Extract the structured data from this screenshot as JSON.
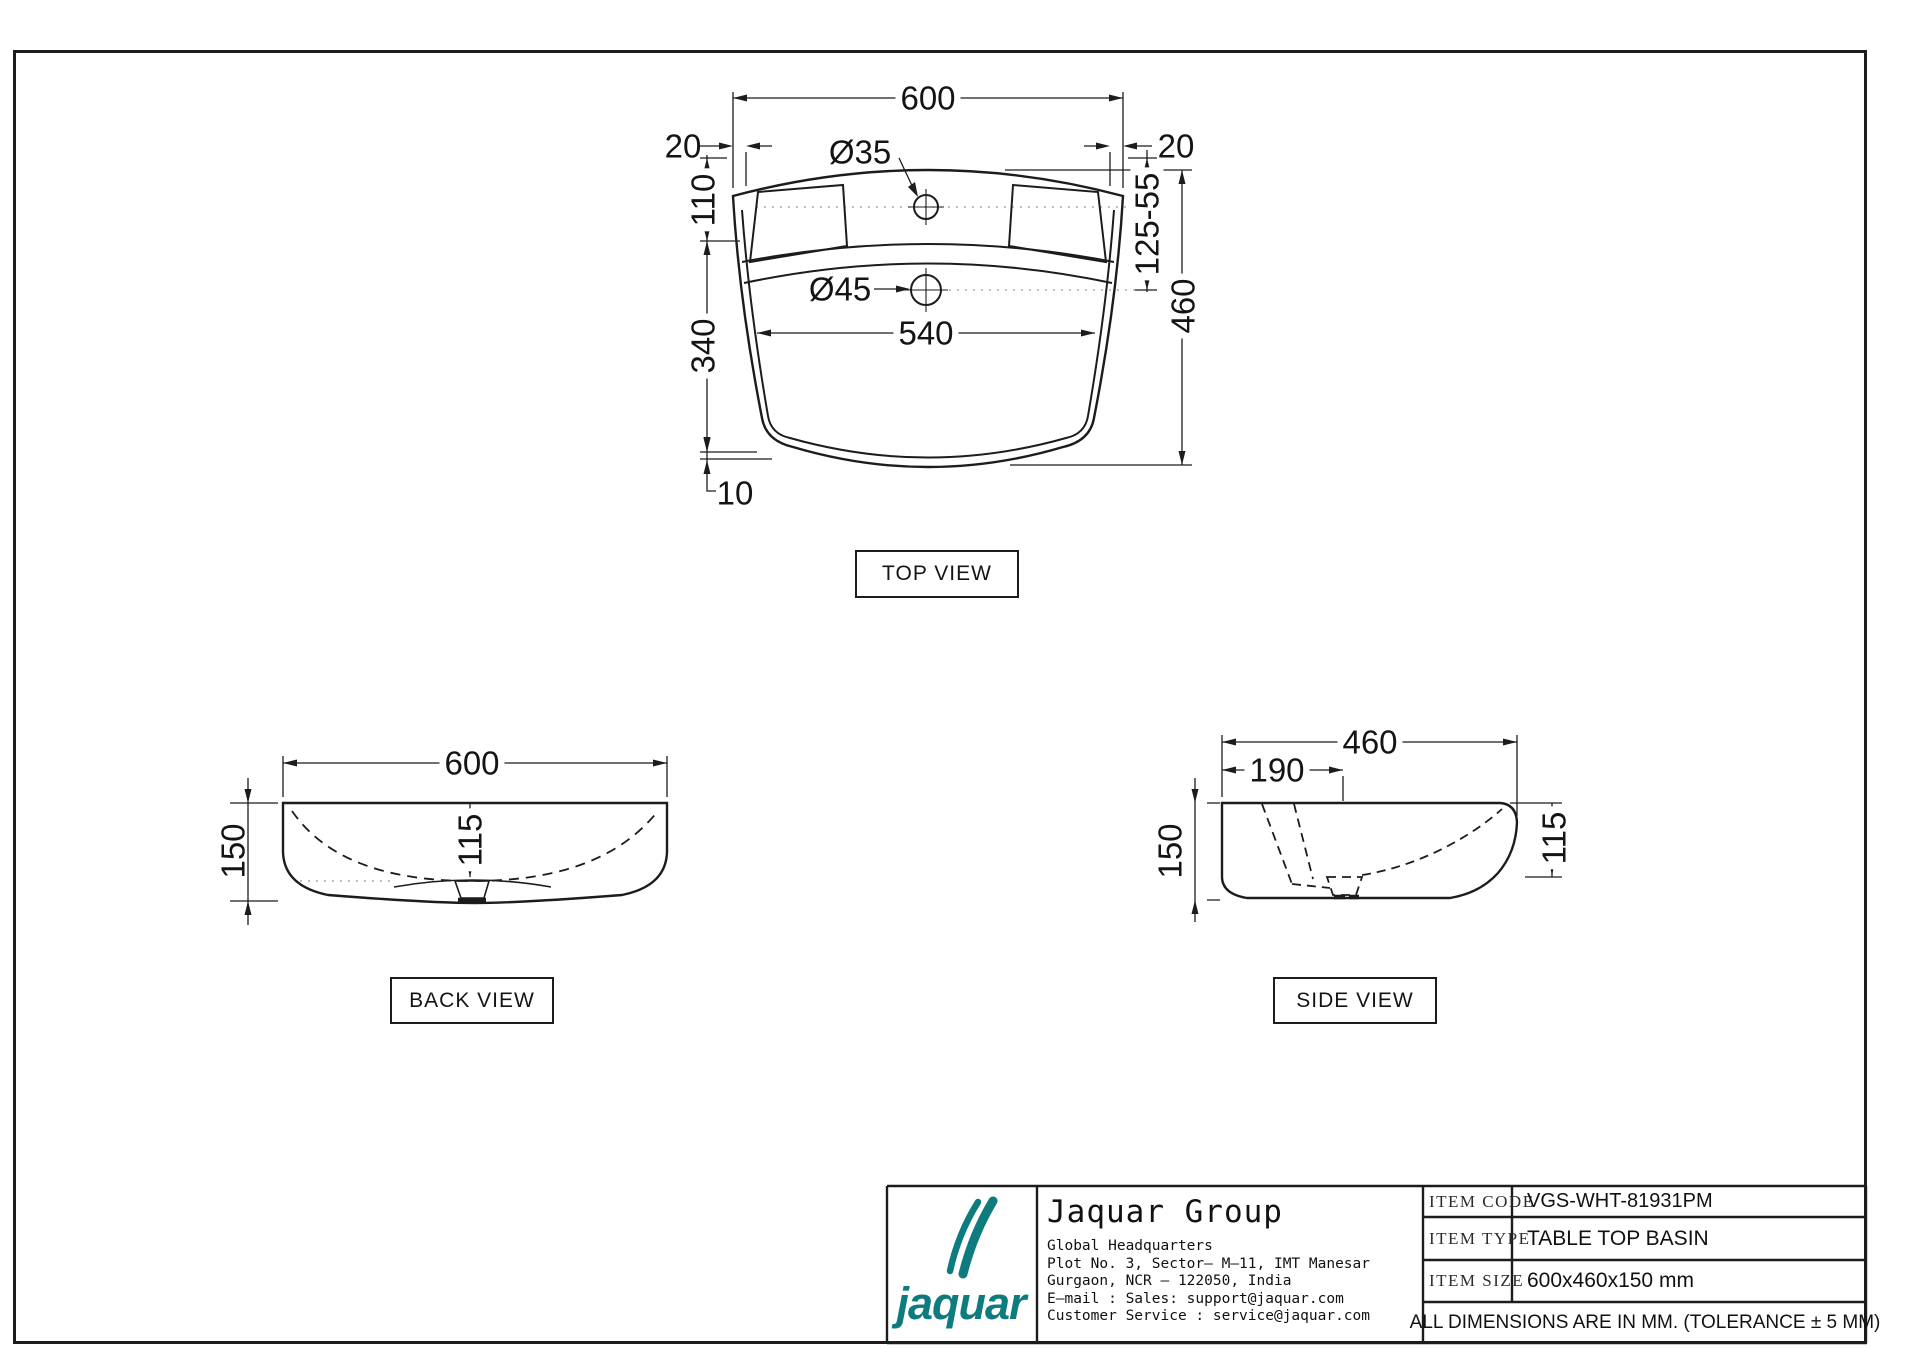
{
  "drawing": {
    "top_view": {
      "label": "TOP VIEW",
      "overall_width": "600",
      "offset_left": "20",
      "offset_right": "20",
      "faucet_hole": "Ø35",
      "drain_hole": "Ø45",
      "deck_depth": "110",
      "bowl_length": "340",
      "wall_thickness": "10",
      "inner_width": "540",
      "hole_offsets": "125-55",
      "overall_depth": "460"
    },
    "back_view": {
      "label": "BACK VIEW",
      "width": "600",
      "height": "150",
      "bowl_depth": "115"
    },
    "side_view": {
      "label": "SIDE VIEW",
      "depth": "460",
      "deck_offset": "190",
      "height": "150",
      "bowl_depth": "115"
    },
    "title_block": {
      "logo_text": "jaquar",
      "company": "Jaquar Group",
      "address_lines": [
        "Global Headquarters",
        "Plot No. 3, Sector– M–11, IMT Manesar",
        "Gurgaon, NCR – 122050, India",
        "E–mail : Sales: support@jaquar.com",
        "Customer Service : service@jaquar.com"
      ],
      "item_code_label": "ITEM CODE",
      "item_code": "VGS-WHT-81931PM",
      "item_type_label": "ITEM TYPE",
      "item_type": "TABLE TOP BASIN",
      "item_size_label": "ITEM SIZE",
      "item_size": "600x460x150 mm",
      "tolerance_note": "ALL DIMENSIONS ARE IN MM. (TOLERANCE ± 5 MM)",
      "accent_color": "#0e7c7e"
    }
  }
}
